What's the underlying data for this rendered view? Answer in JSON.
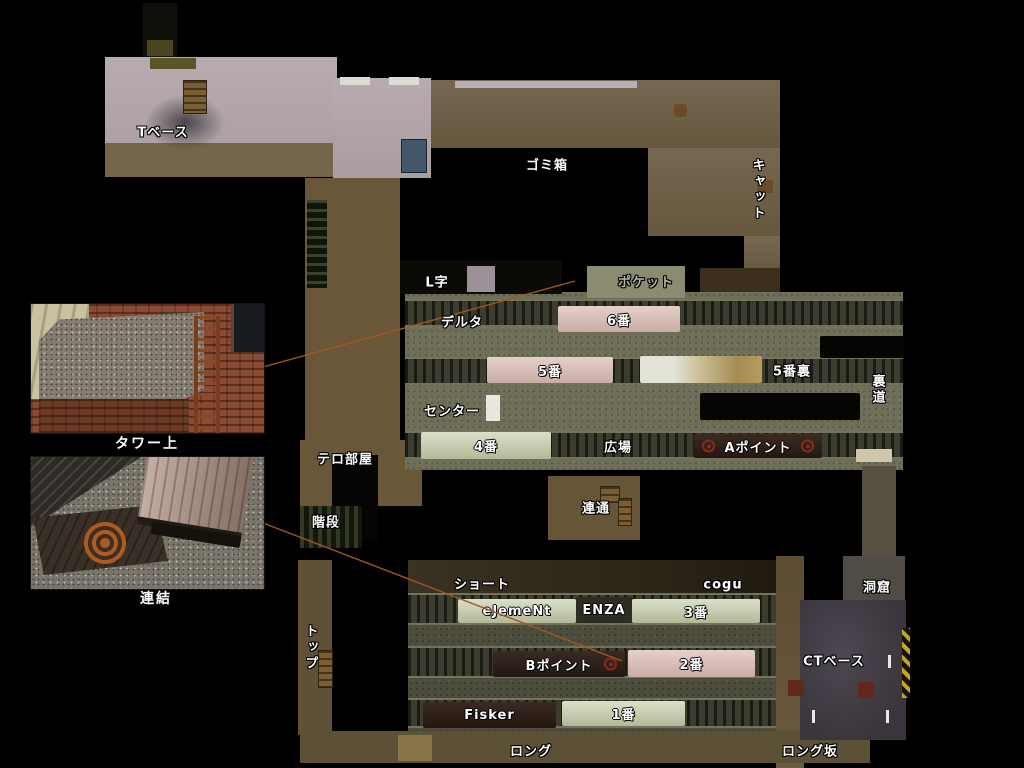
{
  "labels": [
    {
      "id": "t-base",
      "text": "Tベース",
      "x": 163,
      "y": 131
    },
    {
      "id": "gomibako",
      "text": "ゴミ箱",
      "x": 547,
      "y": 164
    },
    {
      "id": "cat",
      "text": "キャット",
      "x": 757,
      "y": 190,
      "vertical": true
    },
    {
      "id": "l-ji",
      "text": "L字",
      "x": 437,
      "y": 281
    },
    {
      "id": "pocket",
      "text": "ポケット",
      "x": 646,
      "y": 281,
      "muted": true
    },
    {
      "id": "delta",
      "text": "デルタ",
      "x": 462,
      "y": 321
    },
    {
      "id": "go-ban-ura",
      "text": "5番裏",
      "x": 792,
      "y": 370
    },
    {
      "id": "uramichi",
      "text": "裏道",
      "x": 877,
      "y": 390,
      "vertical": true
    },
    {
      "id": "center",
      "text": "センター",
      "x": 452,
      "y": 410
    },
    {
      "id": "hiroba",
      "text": "広場",
      "x": 618,
      "y": 446
    },
    {
      "id": "tero-beya",
      "text": "テロ部屋",
      "x": 345,
      "y": 458
    },
    {
      "id": "kaidan",
      "text": "階段",
      "x": 326,
      "y": 521
    },
    {
      "id": "rentsu",
      "text": "連通",
      "x": 596,
      "y": 507
    },
    {
      "id": "short",
      "text": "ショート",
      "x": 482,
      "y": 583
    },
    {
      "id": "cogu",
      "text": "cogu",
      "x": 723,
      "y": 585
    },
    {
      "id": "top",
      "text": "トップ",
      "x": 310,
      "y": 648,
      "vertical": true
    },
    {
      "id": "dokutsu",
      "text": "洞窟",
      "x": 877,
      "y": 586
    },
    {
      "id": "ct-base",
      "text": "CTベース",
      "x": 834,
      "y": 660
    },
    {
      "id": "long",
      "text": "ロング",
      "x": 531,
      "y": 750
    },
    {
      "id": "long-zaka",
      "text": "ロング坂",
      "x": 810,
      "y": 750
    }
  ],
  "trains": [
    {
      "id": "train-6",
      "label": "6番",
      "x": 558,
      "y": 306,
      "w": 122,
      "h": 26,
      "style": "pink"
    },
    {
      "id": "train-5",
      "label": "5番",
      "x": 487,
      "y": 357,
      "w": 126,
      "h": 26,
      "style": "pink"
    },
    {
      "id": "train-5-ura",
      "label": "",
      "x": 640,
      "y": 356,
      "w": 122,
      "h": 27,
      "style": "tan"
    },
    {
      "id": "train-4",
      "label": "4番",
      "x": 421,
      "y": 432,
      "w": 130,
      "h": 27,
      "style": "green"
    },
    {
      "id": "train-a-point",
      "label": "Aポイント",
      "x": 694,
      "y": 434,
      "w": 128,
      "h": 24,
      "style": "dark",
      "targets": "both"
    },
    {
      "id": "train-black-1",
      "label": "",
      "x": 700,
      "y": 393,
      "w": 160,
      "h": 27,
      "style": "black"
    },
    {
      "id": "train-black-2",
      "label": "",
      "x": 820,
      "y": 336,
      "w": 84,
      "h": 22,
      "style": "black"
    },
    {
      "id": "train-element",
      "label": "eJemeNt",
      "x": 458,
      "y": 599,
      "w": 118,
      "h": 24,
      "style": "green"
    },
    {
      "id": "train-enza",
      "label": "ENZA",
      "x": 576,
      "y": 597,
      "w": 56,
      "h": 26,
      "style": "coupler"
    },
    {
      "id": "train-3",
      "label": "3番",
      "x": 632,
      "y": 599,
      "w": 128,
      "h": 24,
      "style": "green"
    },
    {
      "id": "train-b-point",
      "label": "Bポイント",
      "x": 493,
      "y": 651,
      "w": 132,
      "h": 26,
      "style": "dark",
      "targets": "right"
    },
    {
      "id": "train-2",
      "label": "2番",
      "x": 628,
      "y": 650,
      "w": 127,
      "h": 27,
      "style": "pink"
    },
    {
      "id": "train-fisker",
      "label": "Fisker",
      "x": 423,
      "y": 702,
      "w": 133,
      "h": 26,
      "style": "dark"
    },
    {
      "id": "train-1",
      "label": "1番",
      "x": 562,
      "y": 701,
      "w": 123,
      "h": 25,
      "style": "green"
    }
  ],
  "insets": [
    {
      "caption": "タワー上"
    },
    {
      "caption": "連結"
    }
  ],
  "connectors": [
    {
      "x1": 263,
      "y1": 367,
      "x2": 575,
      "y2": 281
    },
    {
      "x1": 263,
      "y1": 523,
      "x2": 622,
      "y2": 661
    }
  ],
  "colors": {
    "connector": "#a3561f",
    "label_text": "#ffffff",
    "label_muted": "#b4b4a2",
    "train_pink": "#d9bcb5",
    "train_green": "#ccd2b5",
    "train_dark": "#2f211b",
    "target_red": "#8a2a1a"
  }
}
